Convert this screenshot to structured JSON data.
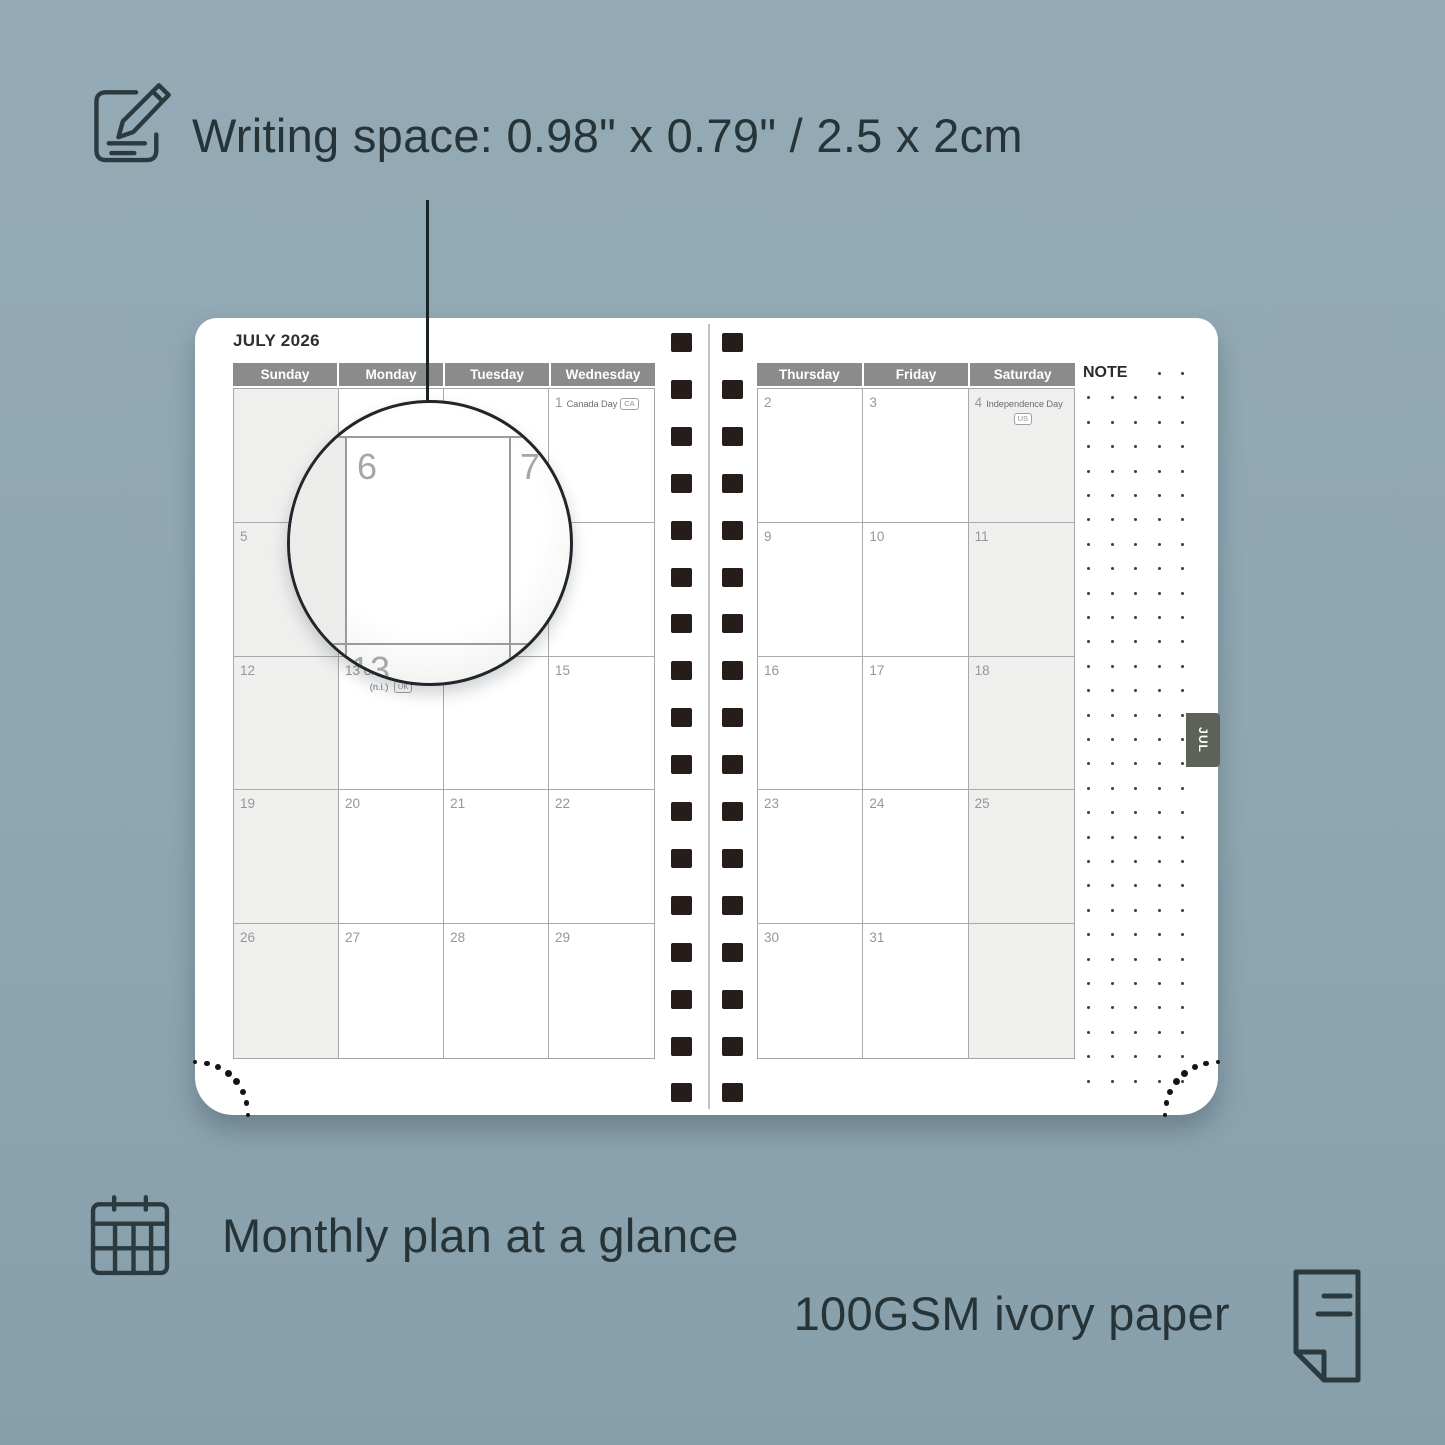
{
  "captions": {
    "writing_space": "Writing space: 0.98\" x 0.79\" / 2.5 x 2cm",
    "monthly_plan": "Monthly plan at a glance",
    "paper": "100GSM ivory paper"
  },
  "planner": {
    "month_title": "JULY 2026",
    "note_label": "NOTE",
    "tab_label": "JUL",
    "left_page": {
      "day_headers": [
        "Sunday",
        "Monday",
        "Tuesday",
        "Wednesday"
      ],
      "shaded_column": 0,
      "weeks": [
        [
          {},
          {},
          {},
          {
            "n": "1",
            "h": "Canada Day",
            "b": "CA",
            "bp": "inline"
          }
        ],
        [
          {
            "n": "5"
          },
          {
            "n": "6"
          },
          {
            "n": "7"
          },
          {
            "n": "8"
          }
        ],
        [
          {
            "n": "12"
          },
          {
            "n": "13",
            "h": "Orangemen's Day",
            "h2": "(n.i.)",
            "b": "UK",
            "bp": "line2"
          },
          {
            "n": "14"
          },
          {
            "n": "15"
          }
        ],
        [
          {
            "n": "19"
          },
          {
            "n": "20"
          },
          {
            "n": "21"
          },
          {
            "n": "22"
          }
        ],
        [
          {
            "n": "26"
          },
          {
            "n": "27"
          },
          {
            "n": "28"
          },
          {
            "n": "29"
          }
        ]
      ]
    },
    "right_page": {
      "day_headers": [
        "Thursday",
        "Friday",
        "Saturday"
      ],
      "shaded_column": 2,
      "weeks": [
        [
          {
            "n": "2"
          },
          {
            "n": "3"
          },
          {
            "n": "4",
            "h": "Independence Day",
            "b": "US",
            "bp": "below"
          }
        ],
        [
          {
            "n": "9"
          },
          {
            "n": "10"
          },
          {
            "n": "11"
          }
        ],
        [
          {
            "n": "16"
          },
          {
            "n": "17"
          },
          {
            "n": "18"
          }
        ],
        [
          {
            "n": "23"
          },
          {
            "n": "24"
          },
          {
            "n": "25"
          }
        ],
        [
          {
            "n": "30"
          },
          {
            "n": "31"
          },
          {}
        ]
      ]
    },
    "magnifier": {
      "big_numbers": [
        "6",
        "7"
      ],
      "partial_number": "13"
    }
  },
  "colors": {
    "background": "#8fa7b2",
    "header_bar": "#8b8b8b",
    "shaded_cell": "#efefee",
    "binding_square": "#261d1a",
    "month_tab": "#5c6258",
    "caption_text": "#263438"
  }
}
